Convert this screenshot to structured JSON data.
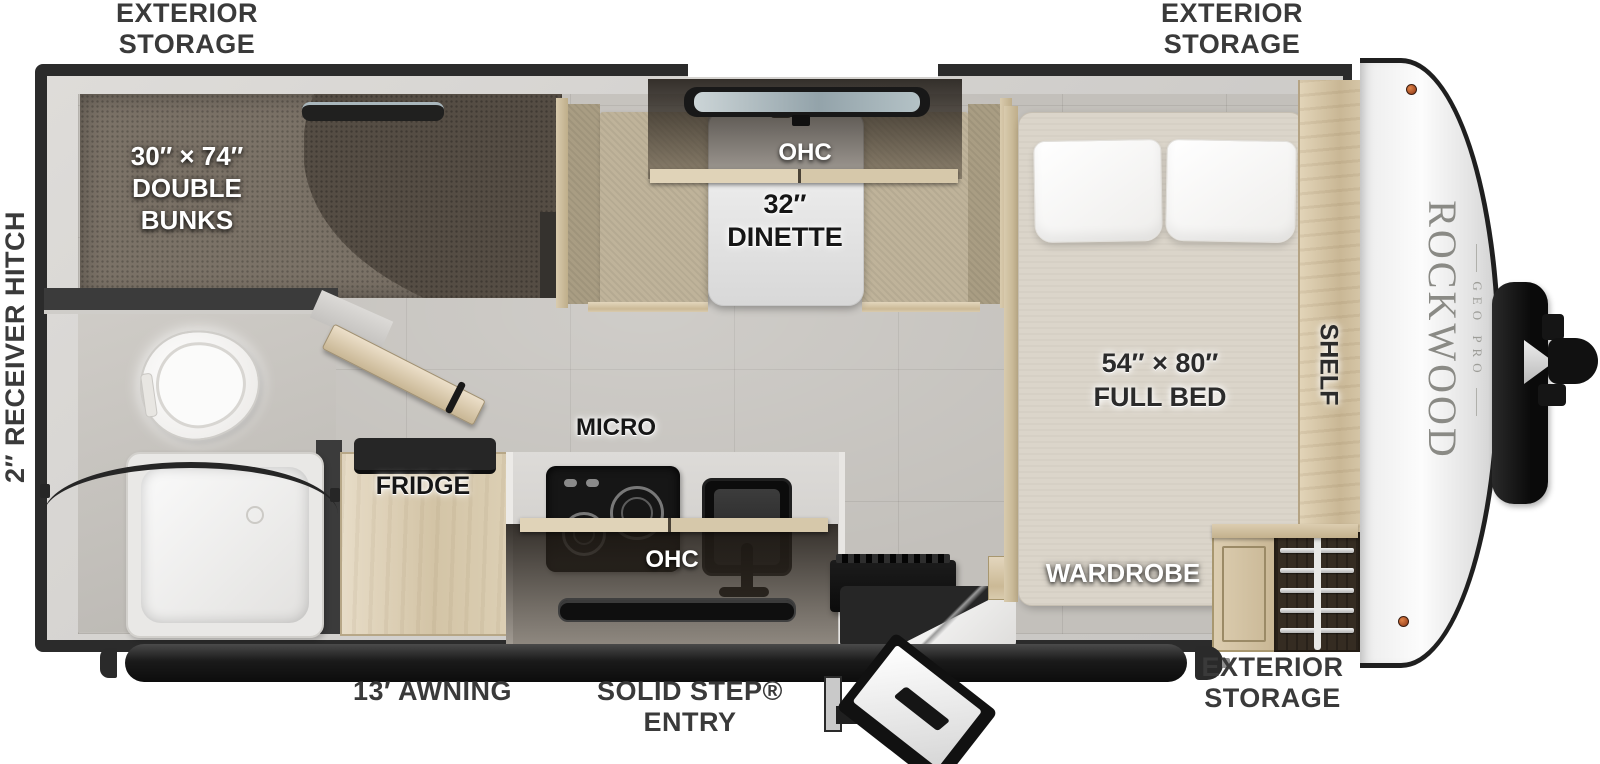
{
  "plan": {
    "brand": "ROCKWOOD",
    "brand_sub": "GEO PRO"
  },
  "exterior": {
    "storage_l1": "EXTERIOR",
    "storage_l2": "STORAGE",
    "receiver_hitch": "2″ RECEIVER HITCH",
    "awning": "13′ AWNING",
    "entry_l1": "SOLID STEP®",
    "entry_l2": "ENTRY"
  },
  "interior": {
    "bunks_l1": "30″ × 74″",
    "bunks_l2": "DOUBLE",
    "bunks_l3": "BUNKS",
    "dinette_ohc": "OHC",
    "dinette_l1": "32″",
    "dinette_l2": "DINETTE",
    "bed_l1": "54″ × 80″",
    "bed_l2": "FULL BED",
    "shelf": "SHELF",
    "wardrobe": "WARDROBE",
    "micro": "MICRO",
    "kitchen_ohc": "OHC",
    "fridge": "FRIDGE"
  },
  "colors": {
    "label": "#3a3a3a",
    "wall": "#2b2b2b",
    "floor_tile": "#c3c0bb",
    "carpet": "#7b7267",
    "wood": "#d3c4a6",
    "bench_fabric": "#bfb39a",
    "bed": "#dbd5ca",
    "cap_white": "#f5f5f5",
    "marker_light": "#b5501f"
  }
}
